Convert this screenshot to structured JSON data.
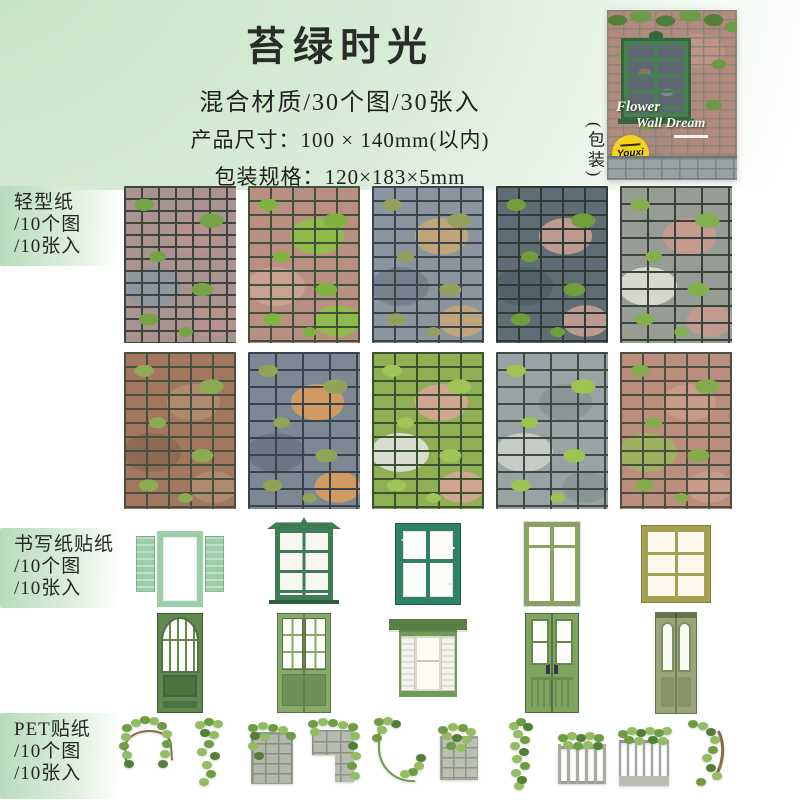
{
  "palette": {
    "page_green": "#c3e2c1",
    "label_green": "#b7dbba",
    "badge_yellow": "#f3d31c",
    "package_window_green": "#47804f",
    "text_dark": "#2a2a2a"
  },
  "header": {
    "title": "苔绿时光",
    "subtitle": "混合材质/30个图/30张入",
    "spec_size_label": "产品尺寸：",
    "spec_size_value": "100 × 140mm(以内)",
    "spec_pack_label": "包装规格：",
    "spec_pack_value": "120×183×5mm"
  },
  "package": {
    "side_label": "(包装)",
    "title_line1": "Flower",
    "title_line2": "Wall Dream",
    "badge_text": "Youxi"
  },
  "sections": {
    "light_paper": {
      "label_lines": [
        "轻型纸",
        "/10个图",
        "/10张入"
      ]
    },
    "writing_sticker": {
      "label_lines": [
        "书写纸贴纸",
        "/10个图",
        "/10张入"
      ]
    },
    "pet_sticker": {
      "label_lines": [
        "PET贴纸",
        "/10个图",
        "/10张入"
      ]
    }
  },
  "brick_tiles": [
    {
      "name": "brick-tile-1",
      "kind": "cobble",
      "desc": "gray-pink cobblestone with moss",
      "colors": {
        "base": "#a89391",
        "mortar": "#3e4540",
        "m": "#76a348",
        "a": "#b5928c",
        "b": "#8e979e"
      }
    },
    {
      "name": "brick-tile-2",
      "kind": "brick",
      "desc": "mossy green and pink brick",
      "colors": {
        "base": "#b98f82",
        "mortar": "#42513c",
        "m": "#7fb23f",
        "a": "#8fbb4a",
        "b": "#c9a190"
      }
    },
    {
      "name": "brick-tile-3",
      "kind": "brick",
      "desc": "blue-gray brick with tan",
      "colors": {
        "base": "#8b95a0",
        "mortar": "#3c434b",
        "m": "#95a05e",
        "a": "#c0a47a",
        "b": "#77828e"
      }
    },
    {
      "name": "brick-tile-4",
      "kind": "brick",
      "desc": "dark blue-gray with moss",
      "colors": {
        "base": "#5f6d74",
        "mortar": "#2e3a36",
        "m": "#6f9e3b",
        "a": "#bd9a90",
        "b": "#51646b"
      }
    },
    {
      "name": "brick-tile-5",
      "kind": "stone",
      "desc": "mixed gray pink white stone",
      "colors": {
        "base": "#979c94",
        "mortar": "#3a423c",
        "m": "#83b04c",
        "a": "#c29a8e",
        "b": "#d6d7cd"
      }
    },
    {
      "name": "brick-tile-6",
      "kind": "brick",
      "desc": "red-brown brick with moss",
      "colors": {
        "base": "#a3765f",
        "mortar": "#47503e",
        "m": "#8cab52",
        "a": "#b08a70",
        "b": "#8f6b55"
      }
    },
    {
      "name": "brick-tile-7",
      "kind": "stone",
      "desc": "blue-gray stone with orange",
      "colors": {
        "base": "#7c8894",
        "mortar": "#39414a",
        "m": "#93a356",
        "a": "#d09a62",
        "b": "#6b7884"
      }
    },
    {
      "name": "brick-tile-8",
      "kind": "brick",
      "desc": "moss-covered green brick",
      "colors": {
        "base": "#8fb052",
        "mortar": "#39532f",
        "m": "#9fc457",
        "a": "#d2a492",
        "b": "#dadcd2"
      }
    },
    {
      "name": "brick-tile-9",
      "kind": "stone",
      "desc": "gray stone bright moss clumps",
      "colors": {
        "base": "#9aa3a3",
        "mortar": "#3f4a44",
        "m": "#9dc351",
        "a": "#8a9596",
        "b": "#c6cbc6"
      }
    },
    {
      "name": "brick-tile-10",
      "kind": "brick",
      "desc": "pink brick with moss columns",
      "colors": {
        "base": "#bb8d7d",
        "mortar": "#4a4f3f",
        "m": "#85ab4d",
        "a": "#c79a89",
        "b": "#9fb05f"
      }
    }
  ],
  "windows": [
    {
      "name": "window-open-shutters",
      "kind": "open-shutters",
      "desc": "mint open shutter window",
      "colors": {
        "c": "#9bcfa7",
        "f": "#6ea87c"
      }
    },
    {
      "name": "window-pediment",
      "kind": "pediment",
      "desc": "forest green pediment window",
      "colors": {
        "c": "#3e7c55",
        "f": "#2c5f40"
      }
    },
    {
      "name": "window-weathered",
      "kind": "weathered",
      "desc": "weathered teal four-pane window",
      "colors": {
        "c": "#2f8069",
        "f": "#1f5f4e"
      }
    },
    {
      "name": "window-tall-double",
      "kind": "tall-double",
      "desc": "olive tall double casement",
      "colors": {
        "c": "#8ba265",
        "f": "#6d8450"
      }
    },
    {
      "name": "window-six-pane",
      "kind": "six-pane",
      "desc": "golden olive six-pane window",
      "colors": {
        "c": "#a5a04f",
        "f": "#83803c"
      }
    }
  ],
  "doors": [
    {
      "name": "door-arch-fanlight",
      "kind": "arch-door",
      "desc": "green door with arched fanlight",
      "colors": {
        "c": "#61894f",
        "c2": "#4e7340",
        "f": "#3c5c33"
      }
    },
    {
      "name": "door-glass-double",
      "kind": "glass-double",
      "desc": "green glass double door",
      "colors": {
        "c": "#86aa6b",
        "c2": "#6d9155",
        "f": "#557243"
      }
    },
    {
      "name": "window-shuttered-cornice",
      "kind": "shutter-window",
      "desc": "shuttered window with cornice",
      "colors": {
        "c": "#6f9a59",
        "c2": "#597f46",
        "f": "#466539"
      }
    },
    {
      "name": "door-panel-double",
      "kind": "panel-double",
      "desc": "double door with tall glass",
      "colors": {
        "c": "#7ea460",
        "c2": "#65894c",
        "f": "#4d6b3b"
      }
    },
    {
      "name": "door-narrow-double",
      "kind": "narrow-double",
      "desc": "narrow ornate double door",
      "colors": {
        "c": "#9aa678",
        "c2": "#7f8d5f",
        "f": "#66744c"
      }
    }
  ],
  "pet_stickers": [
    {
      "name": "pet-sticker-arch-vine",
      "kind": "arch-vine",
      "desc": "ivy arch branch"
    },
    {
      "name": "pet-sticker-hanging-vine",
      "kind": "hanging-vine",
      "desc": "hanging ivy vines"
    },
    {
      "name": "pet-sticker-ivy-wall",
      "kind": "ivy-wall",
      "desc": "stone wall with ivy"
    },
    {
      "name": "pet-sticker-wall-corner",
      "kind": "wall-corner",
      "desc": "stone corner with cascading ivy"
    },
    {
      "name": "pet-sticker-curl-vine",
      "kind": "curl-vine",
      "desc": "curving ivy vine"
    },
    {
      "name": "pet-sticker-stone-ivy",
      "kind": "stone-ivy",
      "desc": "stone block with moss"
    },
    {
      "name": "pet-sticker-vine-column",
      "kind": "vine-column",
      "desc": "vertical ivy column"
    },
    {
      "name": "pet-sticker-fence-ivy",
      "kind": "fence-ivy",
      "desc": "fence with ivy"
    },
    {
      "name": "pet-sticker-balcony-ivy",
      "kind": "balcony-ivy",
      "desc": "balcony railing with ivy"
    },
    {
      "name": "pet-sticker-branch-vine",
      "kind": "branch-vine",
      "desc": "curved ivy branch"
    }
  ]
}
